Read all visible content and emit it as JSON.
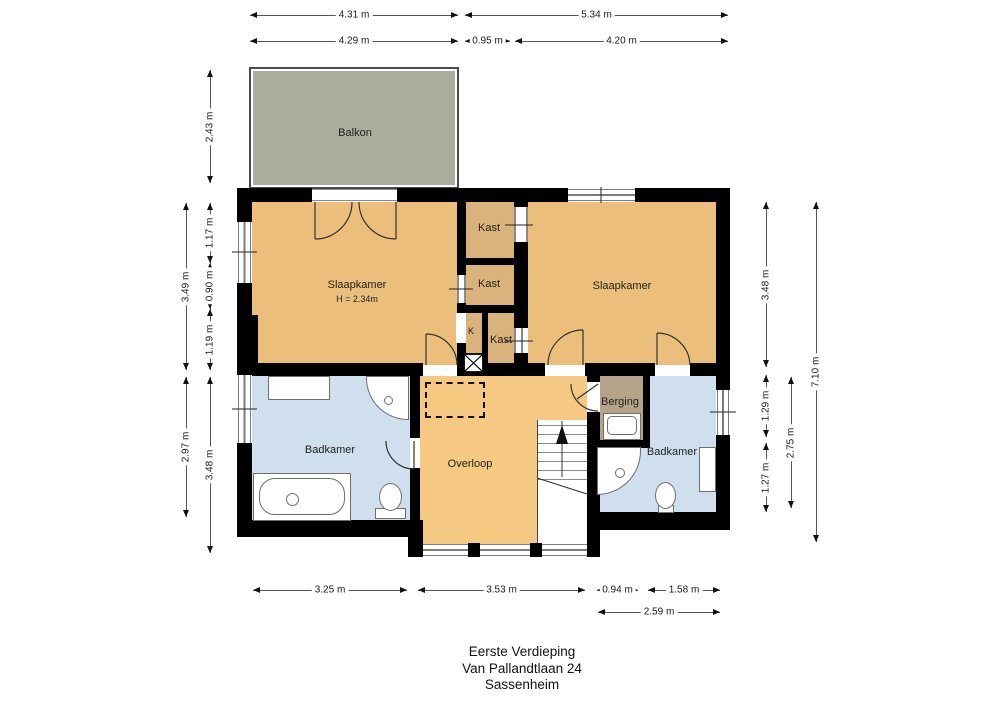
{
  "rooms": {
    "balkon": "Balkon",
    "slaapkamer_left": "Slaapkamer",
    "slaapkamer_left_height": "H = 2.34m",
    "kast_top": "Kast",
    "kast_mid": "Kast",
    "kast_bottom": "Kast",
    "k_shaft": "K",
    "slaapkamer_right": "Slaapkamer",
    "badkamer_left": "Badkamer",
    "overloop": "Overloop",
    "berging": "Berging",
    "badkamer_right": "Badkamer"
  },
  "dimensions": {
    "top_row1": [
      "4.31 m",
      "5.34 m"
    ],
    "top_row2": [
      "4.29 m",
      "0.95 m",
      "4.20 m"
    ],
    "left_outer": [
      "3.49 m",
      "2.97 m"
    ],
    "left_inner": [
      "2.43 m",
      "1.17 m",
      "0.90 m",
      "1.19 m",
      "3.48 m"
    ],
    "right_col1": [
      "3.48 m",
      "1.29 m",
      "1.27 m"
    ],
    "right_col2": [
      "2.75 m"
    ],
    "right_col3": [
      "7.10 m"
    ],
    "bottom_row1": [
      "3.25 m",
      "3.53 m",
      "0.94 m",
      "1.58 m"
    ],
    "bottom_row2": [
      "2.59 m"
    ]
  },
  "footer": {
    "line1": "Eerste Verdieping",
    "line2": "Van Pallandtlaan 24",
    "line3": "Sassenheim"
  },
  "colors": {
    "room_orange": "#ecbe7c",
    "hall_orange": "#f5c981",
    "closet_tan": "#d9b37b",
    "balcony_grey": "#a9ad9c",
    "bathroom_blue": "#cfdfee",
    "storage_taupe": "#b5a489",
    "wall_black": "#000000",
    "window_grey": "#7d7d7d"
  }
}
